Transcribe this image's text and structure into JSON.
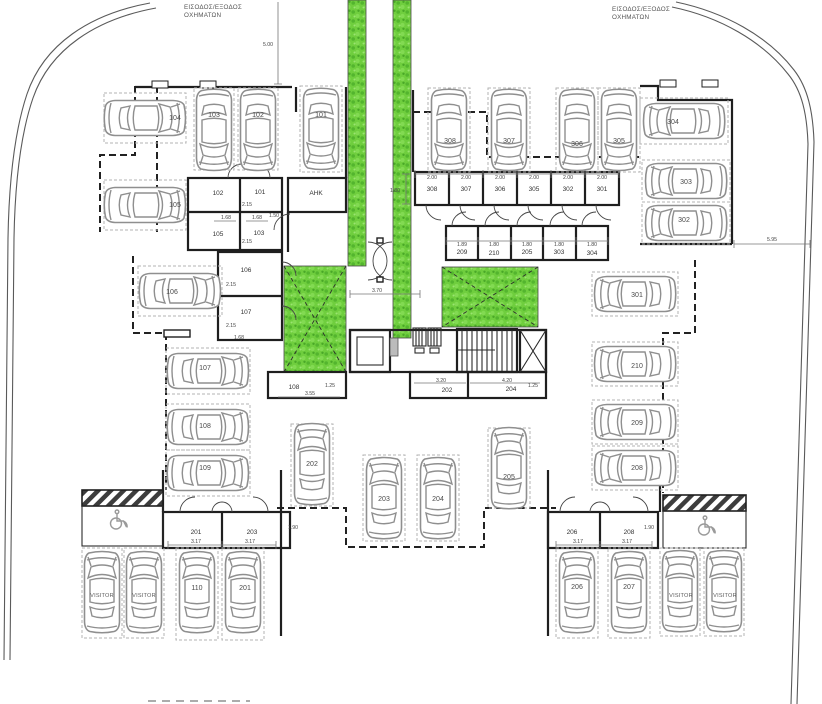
{
  "drawing": {
    "entrance_left": {
      "line1": "ΕΙΣΟΔΟΣ/ΕΞΟΔΟΣ",
      "line2": "ΟΧΗΜΑΤΩΝ"
    },
    "entrance_right": {
      "line1": "ΕΙΣΟΔΟΣ/ΕΞΟΔΟΣ",
      "line2": "ΟΧΗΜΑΤΩΝ"
    },
    "visitor": "VISITOR",
    "ahk": "ΑΗΚ"
  },
  "parking_spots": {
    "p101": "101",
    "p102": "102",
    "p103": "103",
    "p104": "104",
    "p105": "105",
    "p106": "106",
    "p107": "107",
    "p108": "108",
    "p109": "109",
    "p110": "110",
    "p201": "201",
    "p202": "202",
    "p203": "203",
    "p204": "204",
    "p205": "205",
    "p206": "206",
    "p207": "207",
    "p208": "208",
    "p209": "209",
    "p210": "210",
    "p301": "301",
    "p302": "302",
    "p303": "303",
    "p304": "304",
    "p305": "305",
    "p306": "306",
    "p307": "307",
    "p308": "308"
  },
  "storage_rooms": {
    "left_block": {
      "r102": "102",
      "r101": "101",
      "r105": "105",
      "r103": "103",
      "r106": "106",
      "r107": "107"
    },
    "top_row": {
      "r308": "308",
      "r307": "307",
      "r306": "306",
      "r305": "305",
      "r302": "302",
      "r301": "301"
    },
    "mid_row": {
      "r209": "209",
      "r210": "210",
      "r205": "205",
      "r303": "303",
      "r304": "304"
    },
    "corridor": {
      "r108": "108",
      "r202": "202",
      "r204": "204"
    },
    "bottom_left": {
      "r201": "201",
      "r203": "203"
    },
    "bottom_right": {
      "r206": "206",
      "r208": "208"
    }
  },
  "dimensions": {
    "d500": "5.00",
    "d595": "5.95",
    "d370": "3.70",
    "d355": "3.55",
    "d320": "3.20",
    "d420": "4.20",
    "d317": "3.17",
    "d215": "2.15",
    "d200": "2.00",
    "d190": "1.90",
    "d189": "1.89",
    "d180": "1.80",
    "d168": "1.68",
    "d150": "1.50",
    "d125": "1.25"
  },
  "colors": {
    "green": "#6fce3e",
    "green_dark": "#53b52e",
    "wall": "#1f1f1f",
    "car_line": "#8f8f8f"
  }
}
